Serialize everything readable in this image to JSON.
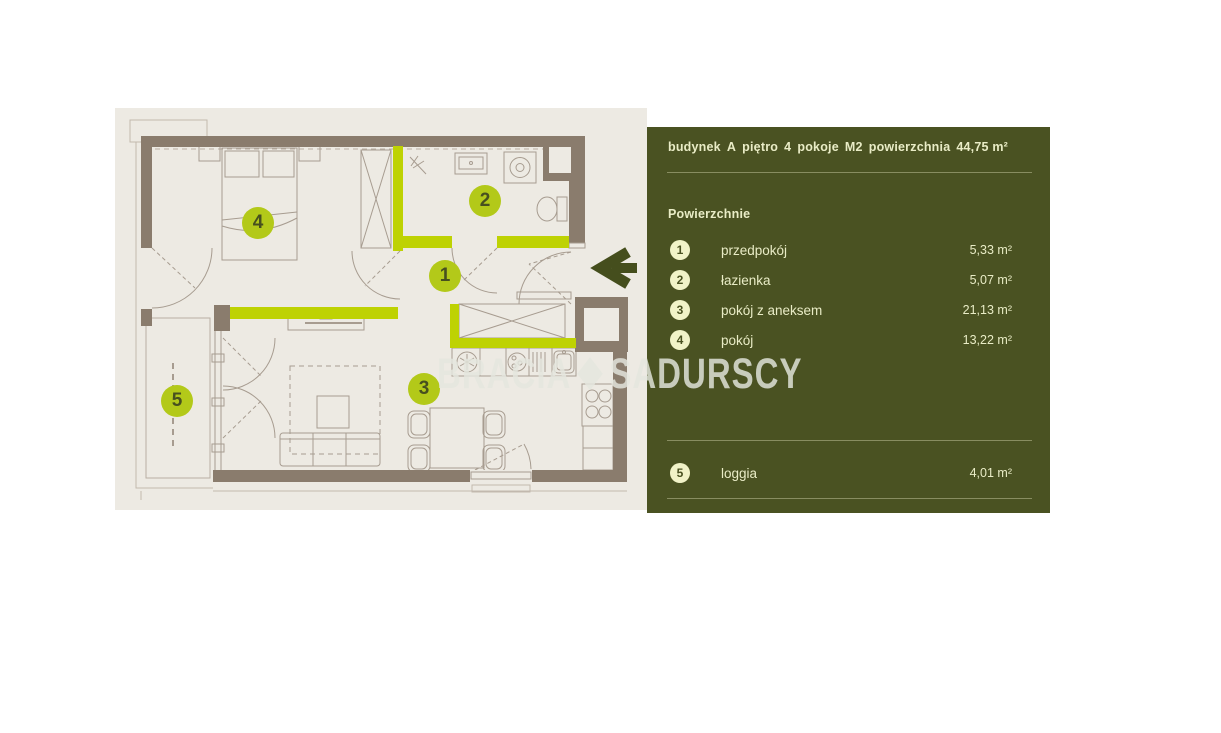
{
  "watermark": {
    "left": "BRACIA",
    "right": "SADURSCY"
  },
  "panel": {
    "header": [
      {
        "label": "budynek",
        "value": "A"
      },
      {
        "label": "piętro",
        "value": "4"
      },
      {
        "label": "pokoje",
        "value": "M2"
      },
      {
        "label": "powierzchnia",
        "value": "44,75 m²"
      }
    ],
    "section_title": "Powierzchnie",
    "rows": [
      {
        "num": "1",
        "label": "przedpokój",
        "area": "5,33 m²"
      },
      {
        "num": "2",
        "label": "łazienka",
        "area": "5,07 m²"
      },
      {
        "num": "3",
        "label": "pokój z aneksem",
        "area": "21,13 m²"
      },
      {
        "num": "4",
        "label": "pokój",
        "area": "13,22 m²"
      }
    ],
    "loggia": {
      "num": "5",
      "label": "loggia",
      "area": "4,01 m²"
    }
  },
  "plan": {
    "badges": [
      {
        "num": "1",
        "x": 330,
        "y": 168
      },
      {
        "num": "2",
        "x": 370,
        "y": 93
      },
      {
        "num": "3",
        "x": 309,
        "y": 281
      },
      {
        "num": "4",
        "x": 143,
        "y": 115
      },
      {
        "num": "5",
        "x": 62,
        "y": 293
      }
    ]
  },
  "colors": {
    "panel_bg": "#4a5222",
    "panel_text": "#e9ecc6",
    "panel_badge_bg": "#f1f3c8",
    "plan_bg": "#edeae3",
    "wall": "#8a7c6d",
    "accent": "#bed203",
    "plan_badge_bg": "#b3c919",
    "arrow": "#454e1d"
  }
}
